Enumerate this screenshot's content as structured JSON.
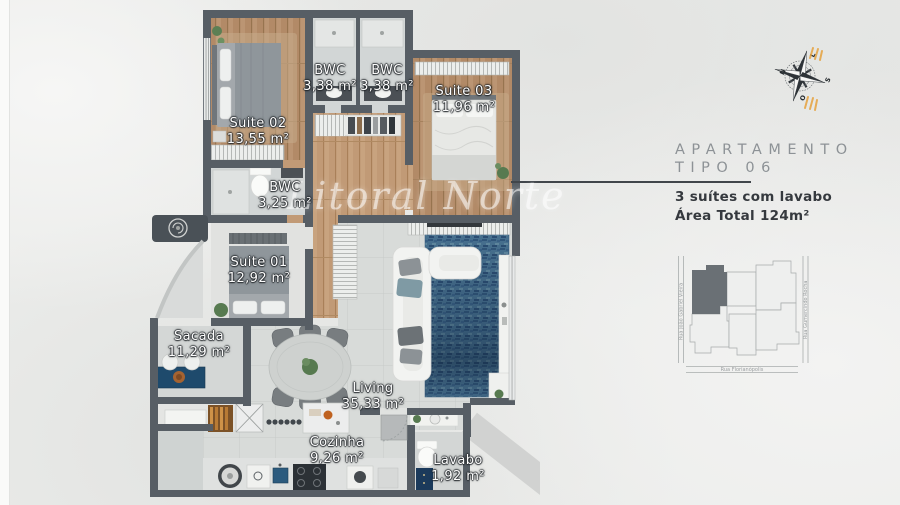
{
  "watermark": "Litoral Norte",
  "floor_plan": {
    "rooms": [
      {
        "name": "Suite 02",
        "area": "13,55 m²"
      },
      {
        "name": "BWC",
        "area": "3,38 m²"
      },
      {
        "name": "BWC",
        "area": "3,38 m²"
      },
      {
        "name": "Suite 03",
        "area": "11,96 m²"
      },
      {
        "name": "BWC",
        "area": "3,25 m²"
      },
      {
        "name": "Suite 01",
        "area": "12,92 m²"
      },
      {
        "name": "Sacada",
        "area": "11,29 m²"
      },
      {
        "name": "Living",
        "area": "35,33 m²"
      },
      {
        "name": "Cozinha",
        "area": "9,26 m²"
      },
      {
        "name": "Lavabo",
        "area": "1,92 m²"
      }
    ]
  },
  "info_panel": {
    "title_line1": "APARTAMENTO",
    "title_line2": "TIPO 06",
    "feature": "3 suítes com lavabo",
    "total_area": "Área Total 124m²"
  },
  "compass": {
    "n": "N",
    "e": "L",
    "s": "S",
    "w": "O"
  },
  "site_map": {
    "street_left": "Rua João Gabriel Vieira",
    "street_right": "Rua Gumercindo Rocha",
    "street_bottom": "Rua Florianópolis"
  },
  "colors": {
    "wall": "#575e65",
    "wood_floor": "#b28a67",
    "rug_blue": "#47708f",
    "counter_blue": "#1e4a6c",
    "map_highlight": "#6a7075"
  }
}
